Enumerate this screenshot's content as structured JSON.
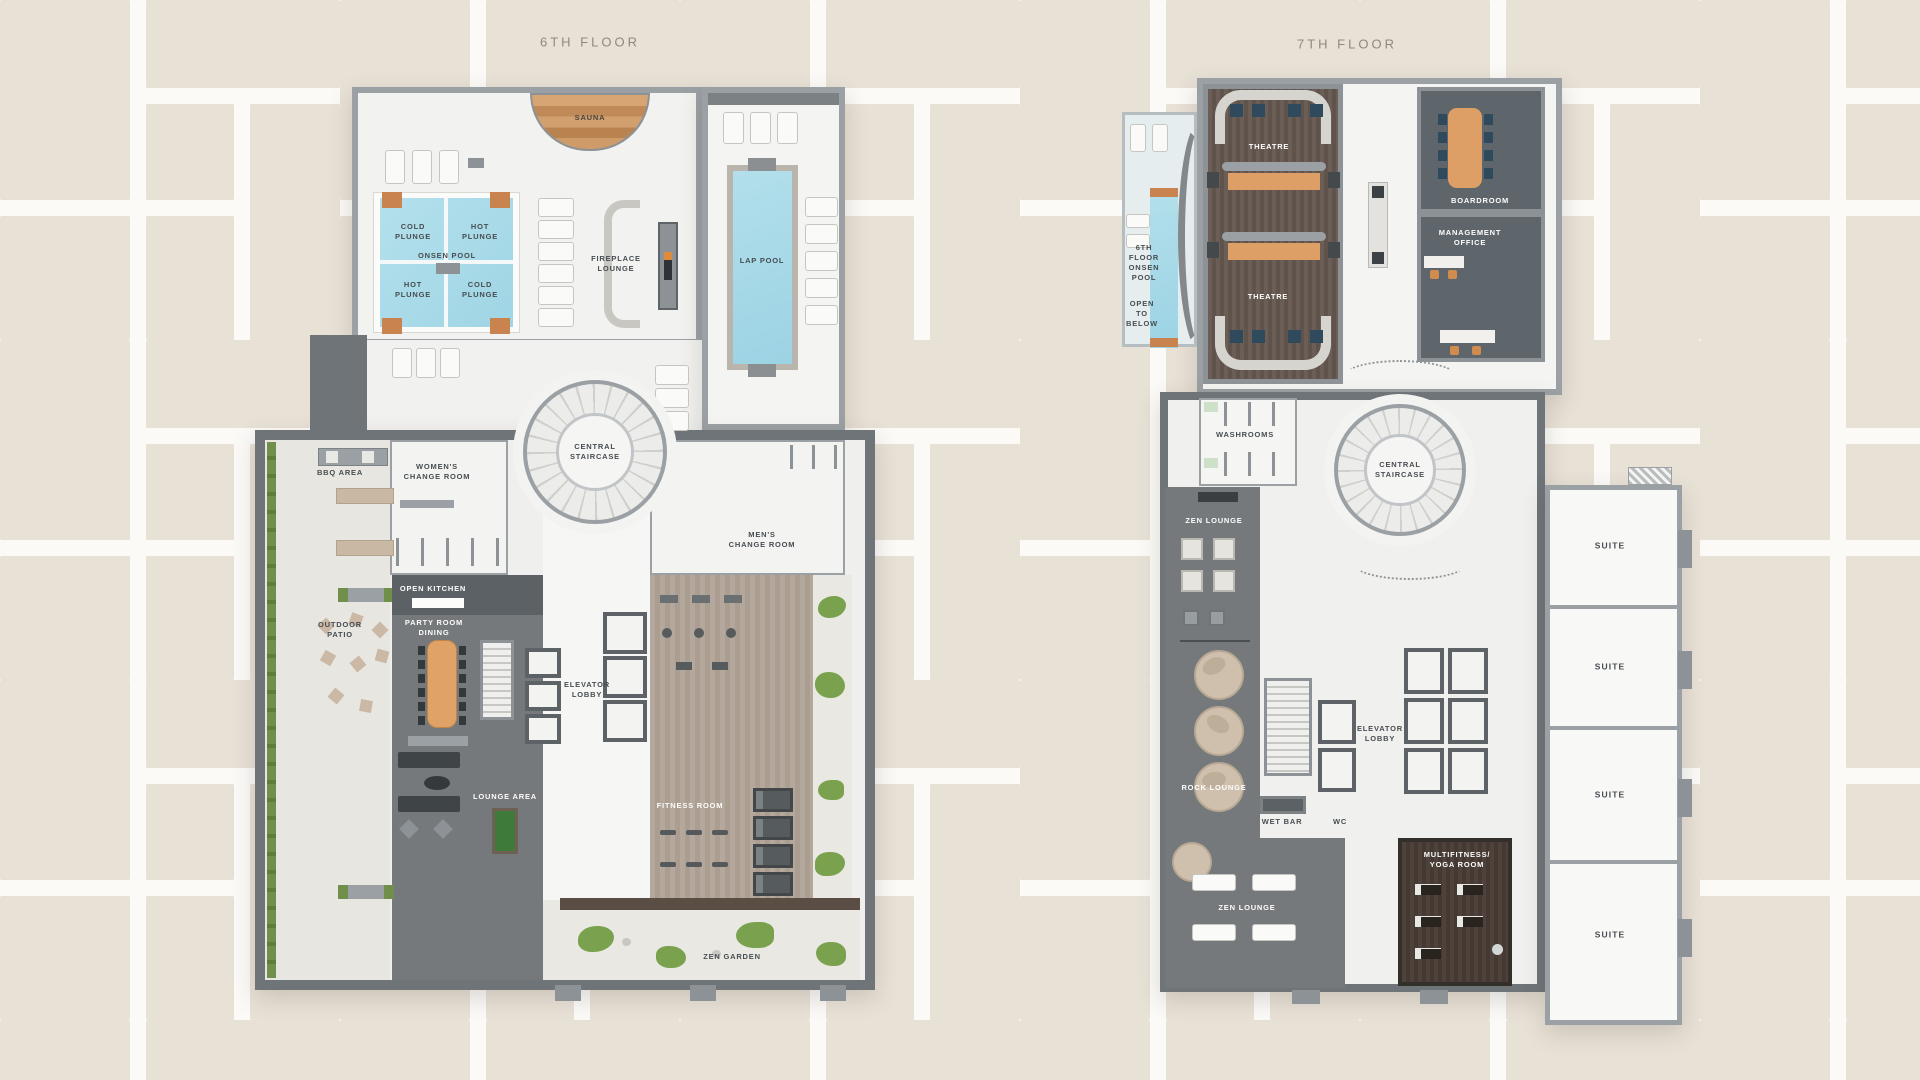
{
  "page": {
    "description": "Amenity floor plans, 6th and 7th floor",
    "background_tile_color": "#e8e1d6",
    "grout_color": "#fbfaf7"
  },
  "colors": {
    "wall_light": "#9ba0a4",
    "wall_dark": "#6e7478",
    "floor_white": "#f2f2f0",
    "floor_dark": "#767b7d",
    "pool_water": "#a9dbe9",
    "wood_accent": "#c8834f",
    "table_orange": "#e0a266",
    "theatre_floor": "#695d55",
    "yoga_floor": "#463c35",
    "fitness_floor": "#b2a598",
    "moss_green": "#7aa24e",
    "seat_blue": "#2e4a5c",
    "label_dark": "#474d51",
    "label_light": "#fdfdfc"
  },
  "floor6": {
    "title": "6TH FLOOR",
    "labels": {
      "sauna": "SAUNA",
      "cold_plunge_tl": "COLD\nPLUNGE",
      "hot_plunge_tr": "HOT\nPLUNGE",
      "onsen_pool": "ONSEN POOL",
      "hot_plunge_bl": "HOT\nPLUNGE",
      "cold_plunge_br": "COLD\nPLUNGE",
      "fireplace_lounge": "FIREPLACE\nLOUNGE",
      "lap_pool": "LAP POOL",
      "central_staircase": "CENTRAL\nSTAIRCASE",
      "womens_change_room": "WOMEN'S\nCHANGE ROOM",
      "mens_change_room": "MEN'S\nCHANGE ROOM",
      "bbq_area": "BBQ AREA",
      "outdoor_patio": "OUTDOOR\nPATIO",
      "open_kitchen": "OPEN KITCHEN",
      "party_room_dining": "PARTY ROOM\nDINING",
      "elevator_lobby": "ELEVATOR\nLOBBY",
      "lounge_area": "LOUNGE AREA",
      "fitness_room": "FITNESS ROOM",
      "zen_garden": "ZEN GARDEN"
    }
  },
  "floor7": {
    "title": "7TH FLOOR",
    "labels": {
      "theatre_upper": "THEATRE",
      "theatre_lower": "THEATRE",
      "boardroom": "BOARDROOM",
      "management_office": "MANAGEMENT\nOFFICE",
      "onsen_pool_open": "6TH\nFLOOR\nONSEN\nPOOL",
      "open_to_below": "OPEN\nTO\nBELOW",
      "washrooms": "WASHROOMS",
      "central_staircase": "CENTRAL\nSTAIRCASE",
      "zen_lounge_upper": "ZEN LOUNGE",
      "rock_lounge": "ROCK LOUNGE",
      "wet_bar": "WET BAR",
      "wc": "WC",
      "elevator_lobby": "ELEVATOR\nLOBBY",
      "multifitness_yoga": "MULTIFITNESS/\nYOGA ROOM",
      "zen_lounge_lower": "ZEN LOUNGE",
      "suite_1": "SUITE",
      "suite_2": "SUITE",
      "suite_3": "SUITE",
      "suite_4": "SUITE"
    }
  }
}
